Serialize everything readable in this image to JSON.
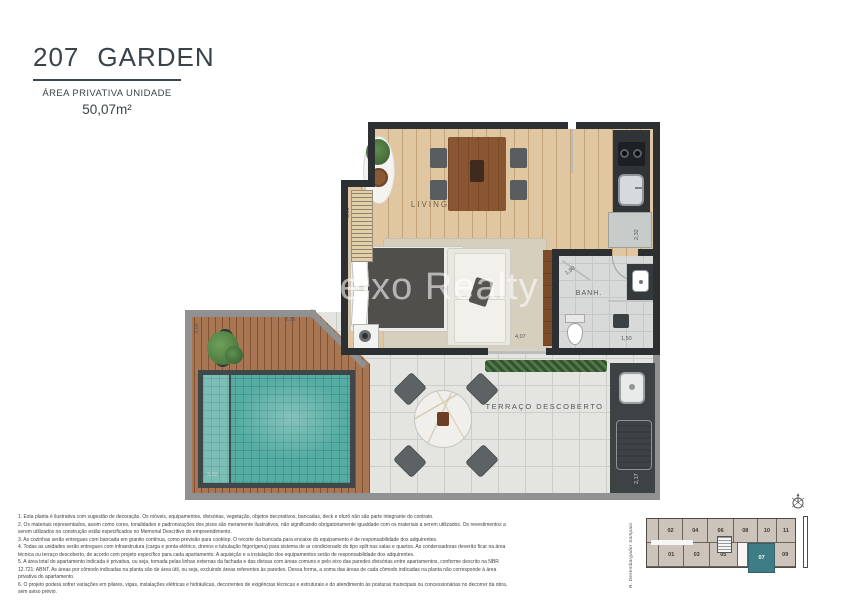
{
  "header": {
    "unit_number": "207",
    "unit_name": "GARDEN",
    "area_label": "ÁREA PRIVATIVA UNIDADE",
    "area_value": "50,07m²"
  },
  "watermark": {
    "icon": "✽",
    "text": "Aleixo Realty"
  },
  "plan": {
    "rooms": {
      "living": "LIVING",
      "bathroom": "BANH.",
      "terrace": "TERRAÇO DESCOBERTO"
    },
    "dimensions": {
      "annex_height": "3,30",
      "kitchen_depth": "2,32",
      "shower": "1,90",
      "bath_width": "1,50",
      "living_width": "4,07",
      "deck_height": "3,05",
      "deck_width": "2,95",
      "pool_width": "3,82",
      "gourmet_height": "2,17"
    }
  },
  "keyplan": {
    "street": "R. Desembargador Sampaio",
    "top_row": [
      "02",
      "04",
      "06",
      "08",
      "10",
      "11"
    ],
    "bottom_row": [
      "01",
      "03",
      "05",
      "07",
      "09"
    ],
    "highlighted_unit": "07",
    "highlight_color": "#3f7d86"
  },
  "disclaimer": {
    "lines": [
      "1. Esta planta é ilustrativa com sugestão de decoração. Os móveis, equipamentos, divisórias, vegetação, objetos decorativos, bancadas, deck e ofurô não são parte integrante do contrato.",
      "2. Os materiais representados, assim como cores, tonalidades e padronizações dos pisos são meramente ilustrativos, não significando obrigatoriamente igualdade com os materiais a serem utilizados. Os revestimentos a serem utilizados na construção estão especificados no Memorial Descritivo do empreendimento.",
      "3. As cozinhas serão entregues com bancada em granito contínua, como previsão para cooktop. O recorte da bancada para encaixe do equipamento é de responsabilidade dos adquirentes.",
      "4. Todas as unidades serão entregues com infraestrutura (carga e ponta elétrico, drenos e tubulação frigorígena) para sistema de ar condicionado do tipo split nas salas e quartos. As condensadoras deverão ficar na área técnica ou terraço descoberto, de acordo com projeto específico para cada apartamento. A aquisição e a instalação dos equipamentos serão de responsabilidade dos adquirentes.",
      "5. A área total do apartamento indicada é privativa, ou seja, tomada pelas linhas externas da fachada e das divisas com áreas comuns e pelo eixo das paredes divisórias entre apartamentos, conforme descrito na NBR 12.721: ABNT. As áreas por cômodo indicadas na planta são de área útil, ou seja, excluindo áreas referentes às paredes. Dessa forma, a soma das áreas de cada cômodo indicadas na planta não corresponde à área privativa do apartamento.",
      "6. O projeto poderá sofrer variações em pilares, vigas, instalações elétricas e hidráulicas, decorrentes de exigências técnicas e estruturais e do atendimento às posturas municipais ou concessionárias no decorrer da obra, sem aviso prévio."
    ]
  },
  "colors": {
    "accent_teal": "#3f7d86",
    "wall_dark": "#2c3033",
    "pool_water": "#55aca2",
    "deck_wood": "#9c6743",
    "floor_wood": "#ddbf94",
    "terrace_wall": "#8f9193"
  }
}
